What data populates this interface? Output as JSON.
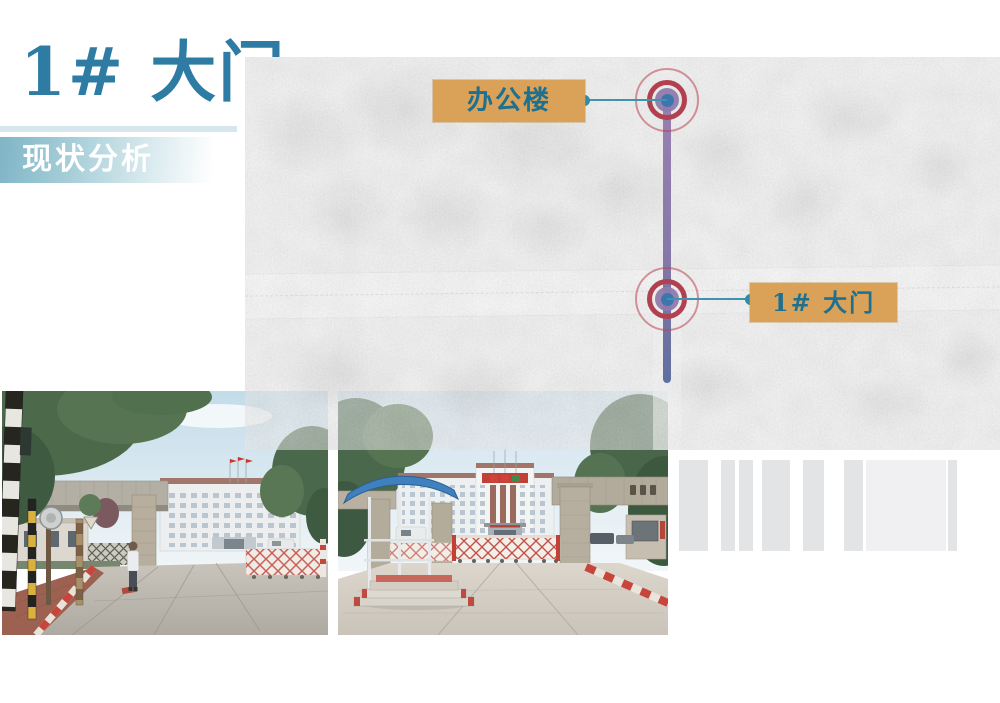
{
  "slide": {
    "title": "1# 大门",
    "subtitle": "现状分析"
  },
  "map": {
    "annotations": [
      {
        "id": "office-building",
        "label": "办公楼"
      },
      {
        "id": "gate-1",
        "label": "1# 大门"
      }
    ]
  },
  "colors": {
    "title_teal": "#2e7ca3",
    "banner_teal": "#7fb5c6",
    "label_bg": "#d9a258",
    "label_text": "#1d7090",
    "marker_ring_red": "#b2414f",
    "marker_center_blue": "#3d76ad",
    "leader_line_purple": "#9a7fb2",
    "leader_line_slate": "#5f6f9f",
    "connector_teal": "#3e93ae"
  }
}
